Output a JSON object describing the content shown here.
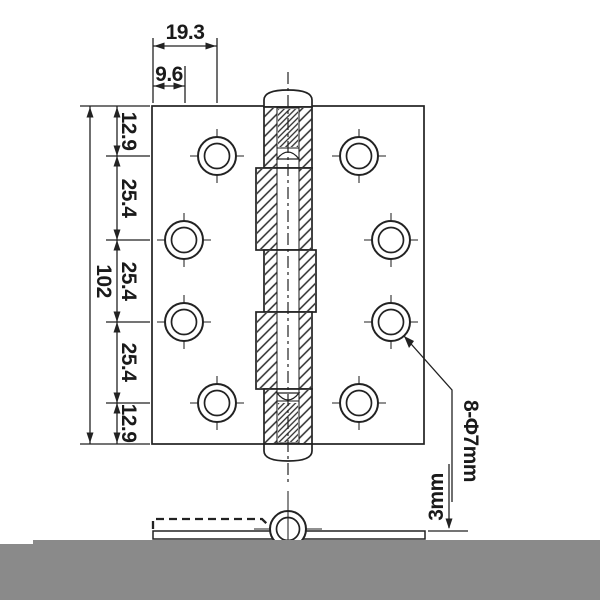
{
  "drawing": {
    "dimensions": {
      "top": {
        "outer": "19.3",
        "inner": "9.6"
      },
      "left": {
        "total": "102",
        "segments": [
          "12.9",
          "25.4",
          "25.4",
          "25.4",
          "12.9"
        ]
      },
      "callouts": {
        "holes": "8-Φ7mm",
        "thickness": "3mm"
      }
    },
    "colors": {
      "line": "#222222",
      "surface_gray": "#8a8a8a",
      "background": "#ffffff"
    }
  }
}
